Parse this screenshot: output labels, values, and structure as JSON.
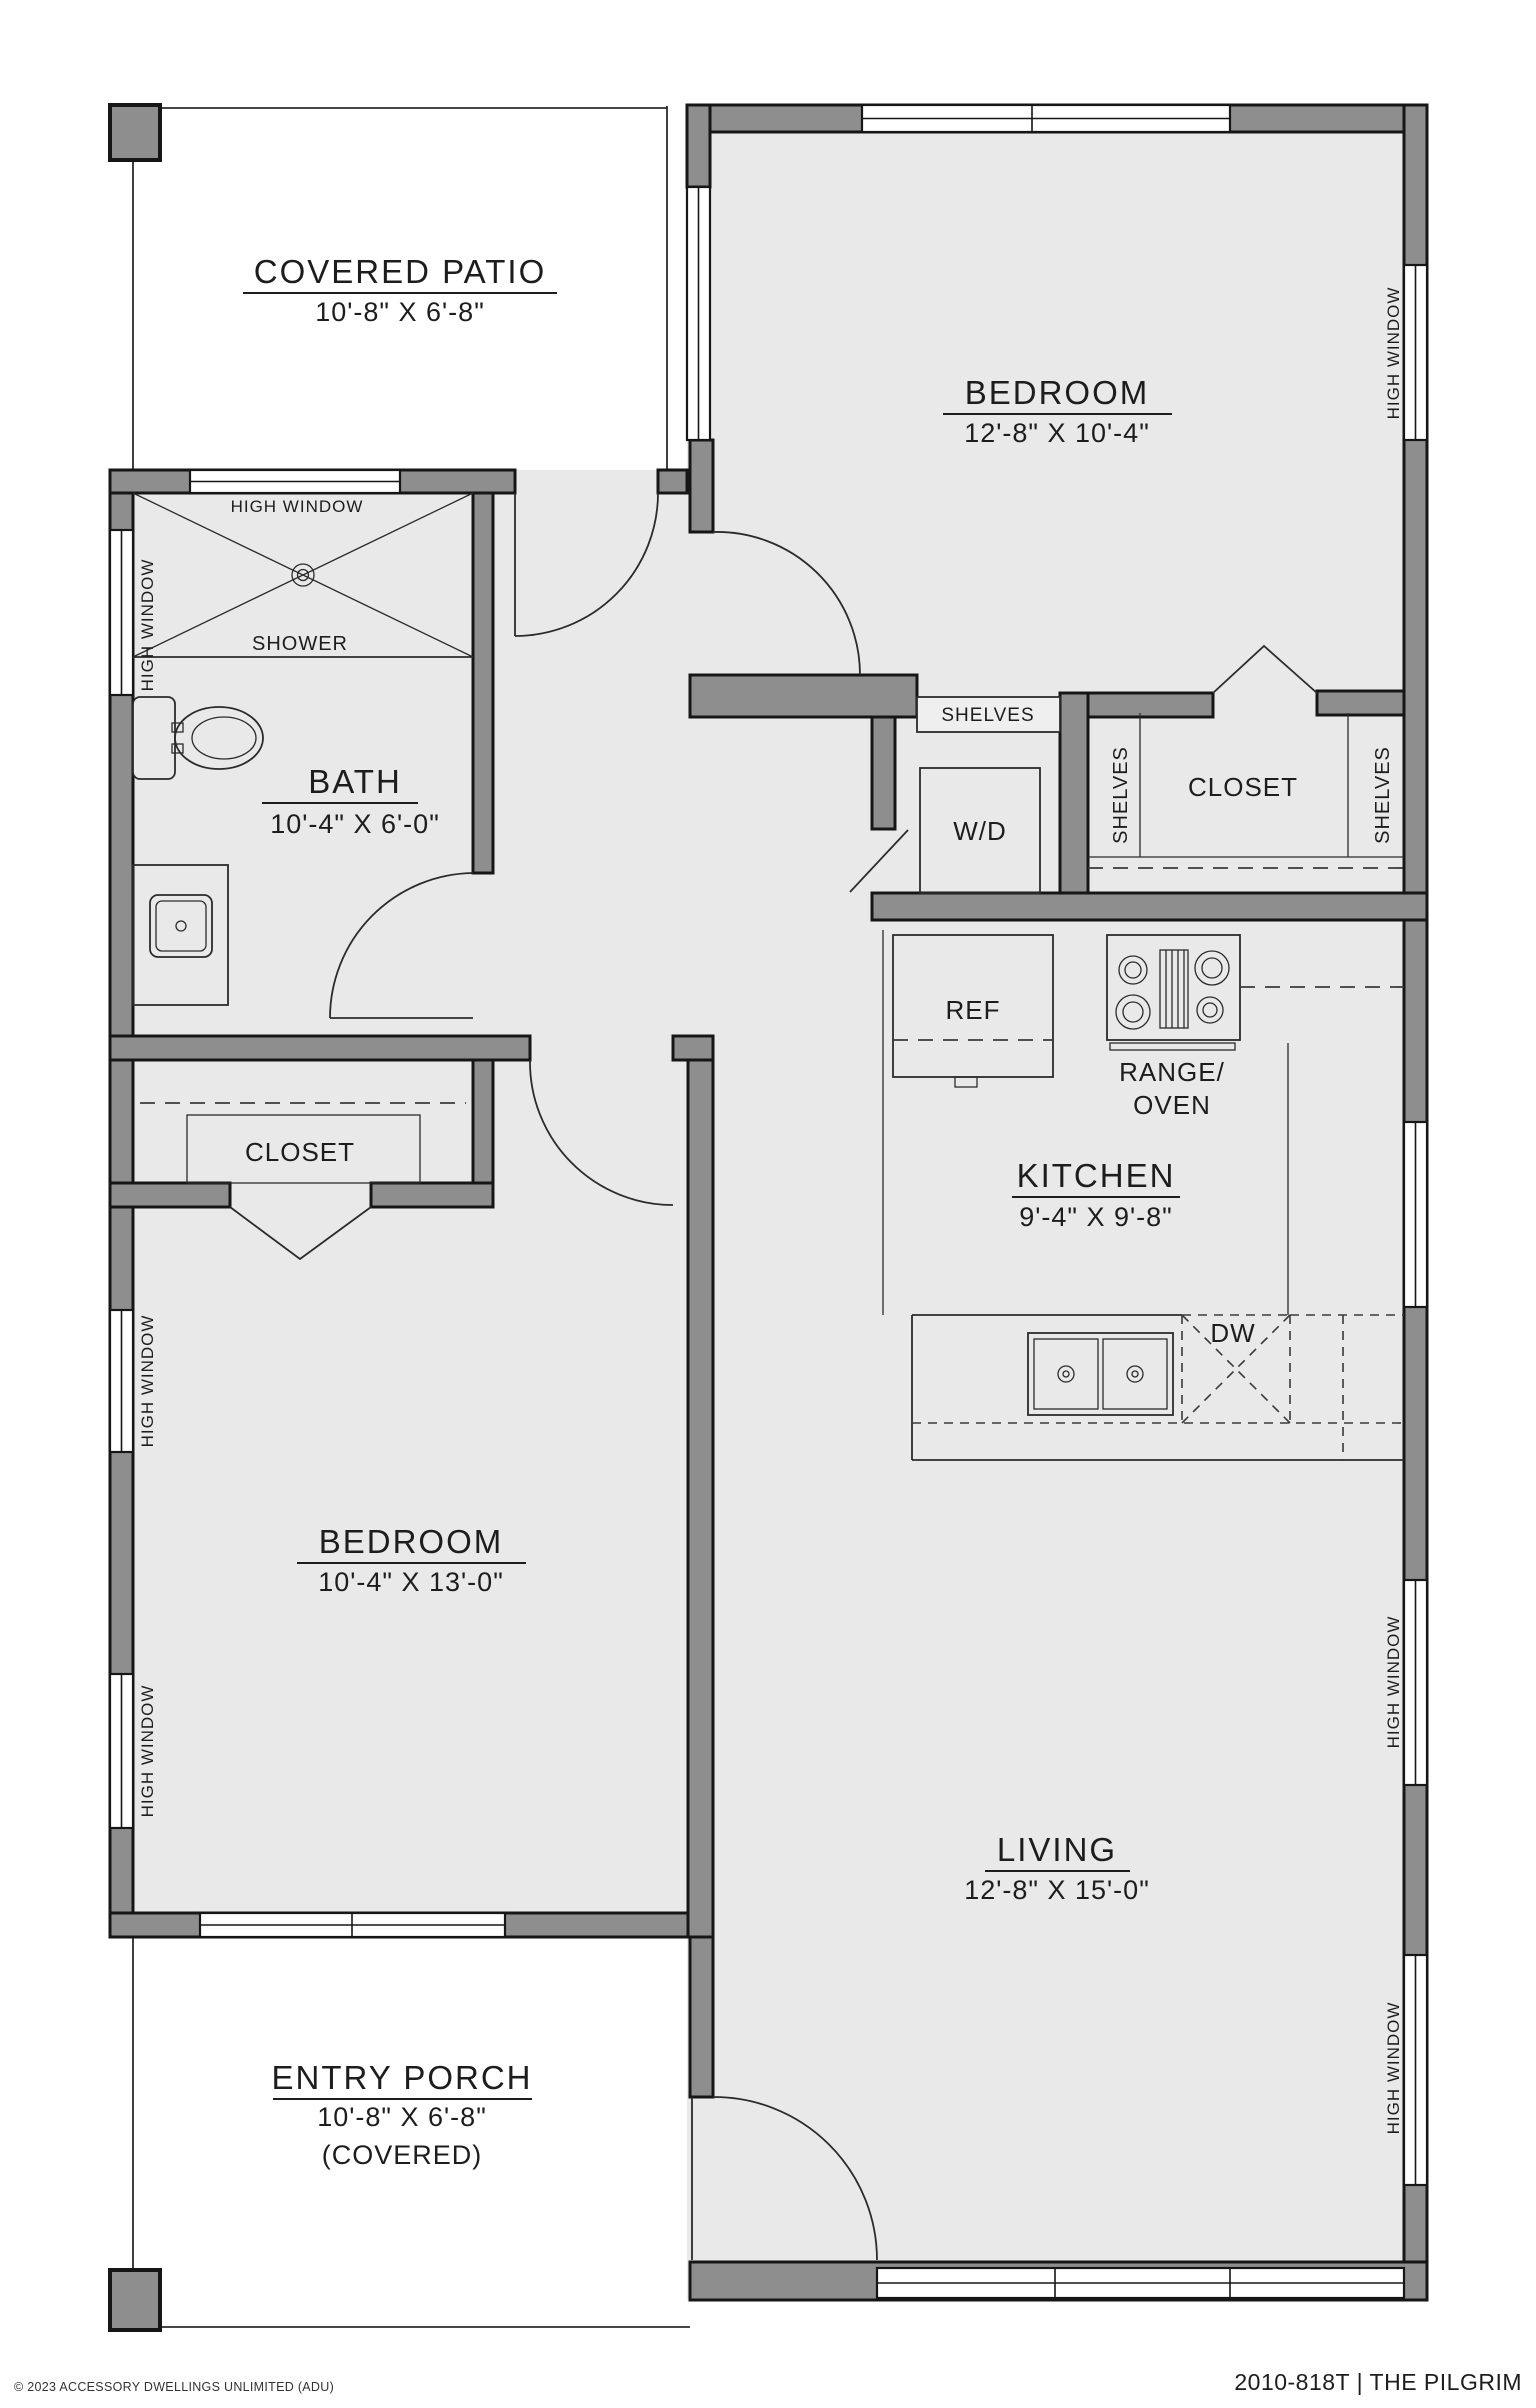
{
  "plan": {
    "footer_left": "© 2023 ACCESSORY DWELLINGS UNLIMITED (ADU)",
    "footer_right": "2010-818T | THE PILGRIM"
  },
  "labels": {
    "high_window": "HIGH WINDOW",
    "shower": "SHOWER",
    "shelves": "SHELVES",
    "closet": "CLOSET",
    "wd": "W/D",
    "ref": "REF",
    "range_line1": "RANGE/",
    "range_line2": "OVEN",
    "dw": "DW"
  },
  "rooms": {
    "covered_patio": {
      "name": "COVERED PATIO",
      "dims": "10'-8\" X 6'-8\""
    },
    "bedroom_1": {
      "name": "BEDROOM",
      "dims": "12'-8\" X 10'-4\""
    },
    "bath": {
      "name": "BATH",
      "dims": "10'-4\" X 6'-0\""
    },
    "kitchen": {
      "name": "KITCHEN",
      "dims": "9'-4\" X 9'-8\""
    },
    "bedroom_2": {
      "name": "BEDROOM",
      "dims": "10'-4\" X 13'-0\""
    },
    "living": {
      "name": "LIVING",
      "dims": "12'-8\" X 15'-0\""
    },
    "entry_porch": {
      "name": "ENTRY PORCH",
      "dims": "10'-8\" X 6'-8\"",
      "note": "(COVERED)"
    }
  },
  "colors": {
    "wall_fill": "#8e8e8e",
    "wall_outline": "#161616",
    "floor": "#e9e9e9",
    "background": "#ffffff",
    "text": "#1d1d1d"
  }
}
